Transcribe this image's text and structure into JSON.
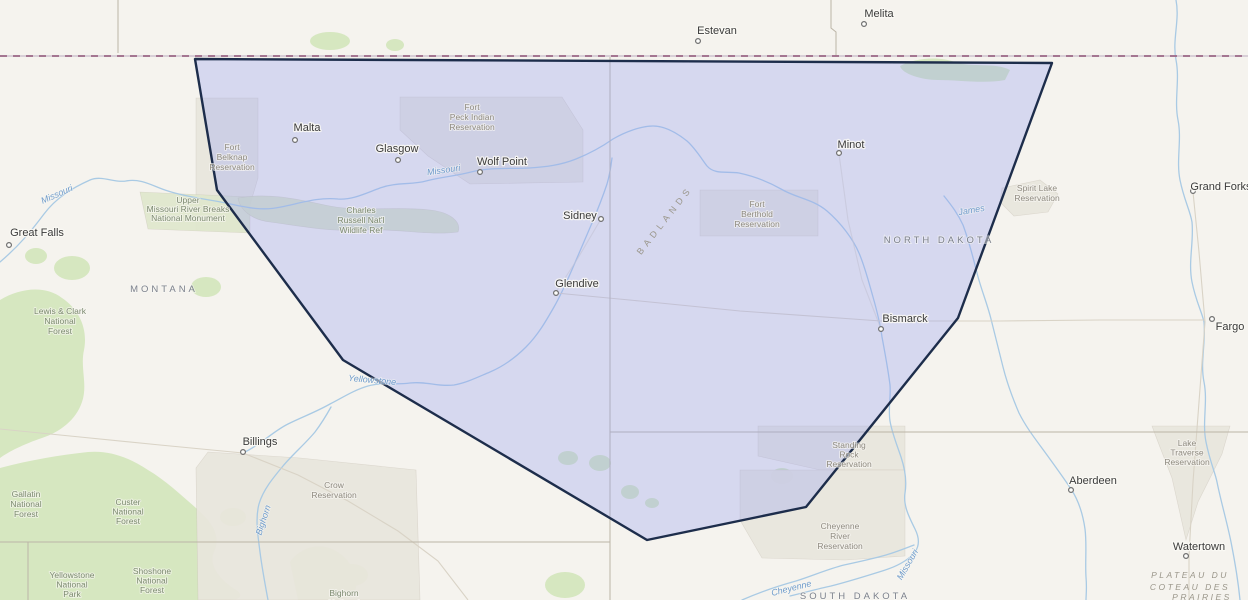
{
  "map": {
    "colors": {
      "background": "#f5f3ee",
      "forest": "#d6e7c0",
      "reservation": "#e9e6dd",
      "monument": "#e0e8cd",
      "refuge": "#dbe5c6",
      "river": "#a9cae4",
      "road": "#d9d3c6",
      "state_border": "#bcb5a7",
      "intl_border_base": "#cfc3cf",
      "intl_border_dash": "#9c6886",
      "overlay_fill": "#969ef4",
      "overlay_stroke": "#1d2d4b"
    },
    "overlay": {
      "fill_opacity": 0.32,
      "stroke_width": 2.4,
      "points": [
        [
          195,
          59
        ],
        [
          1052,
          63
        ],
        [
          958,
          318
        ],
        [
          806,
          507
        ],
        [
          647,
          540
        ],
        [
          343,
          360
        ],
        [
          217,
          190
        ]
      ]
    },
    "terrain": {
      "forests": [
        {
          "name": "lewis-clark-mass",
          "type": "path",
          "d": "M0,300 C20,288 45,285 62,298 C80,310 88,330 84,350 C80,368 88,385 82,402 C76,420 60,432 42,438 C24,444 8,452 0,458 Z"
        },
        {
          "name": "gallatin-custer-mass",
          "type": "path",
          "d": "M0,468 C30,460 60,455 88,452 C110,450 130,458 148,470 C165,480 180,494 196,508 C210,520 222,535 214,552 C208,565 220,580 236,590 C244,595 240,600 230,600 L0,600 Z"
        },
        {
          "name": "bears-paw",
          "type": "ellipse",
          "cx": 72,
          "cy": 268,
          "rx": 18,
          "ry": 12
        },
        {
          "name": "little-rockies",
          "type": "ellipse",
          "cx": 206,
          "cy": 287,
          "rx": 15,
          "ry": 10
        },
        {
          "name": "highwood",
          "type": "ellipse",
          "cx": 36,
          "cy": 256,
          "rx": 11,
          "ry": 8
        },
        {
          "name": "shoshone-mass",
          "type": "path",
          "d": "M96,564 C110,548 130,540 148,548 C166,556 178,572 172,588 C168,596 160,600 150,600 L104,600 Z"
        },
        {
          "name": "bighorn-mtns",
          "type": "path",
          "d": "M290,562 C300,548 318,542 334,550 C348,557 358,572 356,588 C354,596 346,600 336,600 L298,600 Z"
        },
        {
          "name": "crow-patch-1",
          "type": "ellipse",
          "cx": 233,
          "cy": 517,
          "rx": 13,
          "ry": 9
        },
        {
          "name": "crow-patch-2",
          "type": "ellipse",
          "cx": 352,
          "cy": 575,
          "rx": 16,
          "ry": 11
        },
        {
          "name": "turtle-mtns",
          "type": "path",
          "d": "M900,66 C915,58 938,56 955,62 C972,68 995,62 1010,70 L1005,80 C985,84 958,80 938,80 C922,80 902,74 900,66 Z"
        },
        {
          "name": "canada-blob-1",
          "type": "ellipse",
          "cx": 330,
          "cy": 41,
          "rx": 20,
          "ry": 9
        },
        {
          "name": "canada-blob-2",
          "type": "ellipse",
          "cx": 395,
          "cy": 45,
          "rx": 9,
          "ry": 6
        },
        {
          "name": "black-hills-edge",
          "type": "ellipse",
          "cx": 565,
          "cy": 585,
          "rx": 20,
          "ry": 13
        },
        {
          "name": "badlands-blob-1",
          "type": "ellipse",
          "cx": 568,
          "cy": 458,
          "rx": 10,
          "ry": 7
        },
        {
          "name": "badlands-blob-2",
          "type": "ellipse",
          "cx": 600,
          "cy": 463,
          "rx": 11,
          "ry": 8
        },
        {
          "name": "badlands-blob-3",
          "type": "ellipse",
          "cx": 630,
          "cy": 492,
          "rx": 9,
          "ry": 7
        },
        {
          "name": "badlands-blob-4",
          "type": "ellipse",
          "cx": 652,
          "cy": 503,
          "rx": 7,
          "ry": 5
        },
        {
          "name": "badlands-blob-5",
          "type": "ellipse",
          "cx": 782,
          "cy": 476,
          "rx": 11,
          "ry": 8
        }
      ],
      "areas": [
        {
          "name": "fort-peck-reservation",
          "kind": "reservation",
          "d": "M400,97 L562,97 L583,130 L583,182 L470,184 L428,156 L400,130 Z"
        },
        {
          "name": "fort-belknap-reservation",
          "kind": "reservation",
          "d": "M196,98 L258,98 L258,178 L242,232 L196,230 Z"
        },
        {
          "name": "fort-berthold-reservation",
          "kind": "reservation",
          "d": "M700,190 L818,190 L818,236 L700,236 Z"
        },
        {
          "name": "standing-rock-reservation",
          "kind": "reservation",
          "d": "M758,426 L905,426 L905,470 L820,470 L758,456 Z"
        },
        {
          "name": "cheyenne-river-reservation",
          "kind": "reservation",
          "d": "M740,470 L905,470 L905,556 L845,560 L762,558 L740,520 Z"
        },
        {
          "name": "crow-reservation",
          "kind": "reservation",
          "d": "M208,452 L300,458 L416,470 L420,600 L198,600 L196,468 Z"
        },
        {
          "name": "lake-traverse-reservation",
          "kind": "reservation",
          "d": "M1152,426 L1230,426 L1222,454 L1198,502 L1186,540 L1172,478 L1158,442 Z"
        },
        {
          "name": "spirit-lake-reservation",
          "kind": "reservation",
          "d": "M1002,188 L1040,180 L1058,194 L1048,212 L1014,216 L1000,202 Z"
        },
        {
          "name": "upper-missouri-monument",
          "kind": "monument",
          "d": "M140,192 L250,197 L250,233 L148,229 Z"
        },
        {
          "name": "charles-russell-refuge",
          "kind": "refuge",
          "d": "M238,198 C270,192 300,200 330,206 C360,212 395,206 430,210 C450,212 462,222 458,232 C430,236 395,228 360,230 C330,232 300,226 270,222 C252,220 240,210 238,198 Z"
        }
      ]
    },
    "rivers": [
      {
        "name": "missouri-river",
        "d": "M0,262 C20,245 32,230 44,214 C56,198 72,188 90,180 C102,175 114,183 126,181 C142,178 154,187 168,191 C186,197 206,199 226,203 C248,208 263,211 281,207 C301,203 318,197 338,199 C352,200 364,194 380,188 C396,182 412,185 426,181 C441,177 456,176 471,172 C491,167 511,169 529,168 C546,167 561,165 576,159 C591,153 603,146 613,139 C625,132 641,126 653,126 C665,126 677,133 687,141 C695,148 701,158 707,166 C715,175 727,171 739,173 C753,176 767,181 781,189 C796,198 813,199 827,211 C841,223 853,239 859,253 C865,267 869,283 873,297 C877,311 880,323 882,337 C885,353 888,369 890,385 C891,397 888,409 890,421 C892,433 897,445 901,457 C905,469 907,481 905,493 C903,505 909,517 915,529 C919,537 920,545 915,552 C907,562 893,568 879,572 C863,577 847,582 831,586 C817,589 803,593 790,596"
      },
      {
        "name": "yellowstone-river",
        "d": "M243,453 C262,444 272,432 288,424 C302,417 316,412 330,404 C342,398 354,390 368,386 C382,382 396,385 410,383 C426,381 438,387 454,385 C466,383 478,377 490,372 C504,366 516,357 526,347 C538,335 546,321 554,307 C562,293 568,279 574,265 C580,251 586,237 592,223 C598,209 603,196 607,184 C610,174 611,166 612,158"
      },
      {
        "name": "bighorn-river",
        "d": "M268,600 C265,584 262,568 260,552 C258,536 255,519 259,504 C263,490 273,478 283,466 C293,454 305,444 315,432 C321,424 326,416 331,407"
      },
      {
        "name": "red-river",
        "d": "M1176,0 C1180,20 1172,40 1176,60 C1180,80 1174,100 1178,120 C1182,140 1176,160 1180,180 C1184,200 1190,210 1192,222 C1194,242 1188,262 1192,282 C1196,302 1202,312 1204,322 C1206,342 1200,362 1204,382 C1208,402 1202,422 1206,442 C1210,462 1215,472 1217,482 C1221,502 1227,522 1231,542 C1235,562 1238,580 1240,600"
      },
      {
        "name": "james-river",
        "d": "M944,196 C952,206 958,214 963,225 C969,241 973,257 977,273 C981,289 987,303 991,319 C995,335 999,351 1003,367 C1007,383 1013,399 1019,413 C1027,429 1037,441 1047,455 C1055,466 1063,477 1071,489 C1079,501 1083,515 1085,529 C1087,545 1085,561 1086,577 C1087,589 1086,595 1086,600"
      },
      {
        "name": "cheyenne-river",
        "d": "M742,600 C760,592 778,586 796,581 C812,576 828,569 844,565 C858,562 872,559 886,555 C896,552 906,548 914,545"
      }
    ],
    "roads": [
      {
        "name": "interstate-94",
        "opacity": 1,
        "d": "M556,293 L640,301 L740,311 L881,321 L1000,321 L1100,320 L1205,320"
      },
      {
        "name": "interstate-29",
        "opacity": 1,
        "d": "M1193,192 L1199,252 L1205,322 L1199,402 L1193,482 L1189,556 L1189,600"
      },
      {
        "name": "interstate-90",
        "opacity": 1,
        "d": "M0,429 L80,437 L160,445 L243,453 L298,475 L348,501 L398,531 L438,561 L468,600"
      },
      {
        "name": "us-83",
        "opacity": 0.6,
        "d": "M881,329 L862,280 L848,220 L839,154"
      },
      {
        "name": "glendive-sidney-road",
        "opacity": 0.6,
        "d": "M556,292 L578,258 L601,219"
      }
    ],
    "borders": {
      "international": {
        "name": "us-canada-border",
        "d": "M0,56 L1248,56"
      },
      "state": [
        {
          "name": "montana-dakota-border",
          "d": "M610,57 L610,542"
        },
        {
          "name": "nd-sd-border",
          "d": "M610,432 L1248,432"
        },
        {
          "name": "montana-wyoming-border",
          "d": "M0,542 L610,542"
        },
        {
          "name": "wyoming-sd-border",
          "d": "M610,542 L610,600"
        },
        {
          "name": "alberta-sask-border",
          "d": "M118,0 L118,53"
        },
        {
          "name": "sask-manitoba-border",
          "d": "M831,0 L831,28 L836,32 L836,56"
        },
        {
          "name": "yellowstone-park-boundary",
          "d": "M28,542 L28,600"
        }
      ]
    },
    "cities": [
      {
        "name": "estevan",
        "label": "Estevan",
        "tx": 717,
        "ty": 34,
        "mx": 698,
        "my": 41
      },
      {
        "name": "melita",
        "label": "Melita",
        "tx": 879,
        "ty": 17,
        "mx": 864,
        "my": 24
      },
      {
        "name": "malta",
        "label": "Malta",
        "tx": 307,
        "ty": 131,
        "mx": 295,
        "my": 140
      },
      {
        "name": "glasgow",
        "label": "Glasgow",
        "tx": 397,
        "ty": 152,
        "mx": 398,
        "my": 160
      },
      {
        "name": "wolf-point",
        "label": "Wolf Point",
        "tx": 502,
        "ty": 165,
        "mx": 480,
        "my": 172
      },
      {
        "name": "sidney",
        "label": "Sidney",
        "tx": 580,
        "ty": 219,
        "mx": 601,
        "my": 219
      },
      {
        "name": "glendive",
        "label": "Glendive",
        "tx": 577,
        "ty": 287,
        "mx": 556,
        "my": 293
      },
      {
        "name": "minot",
        "label": "Minot",
        "tx": 851,
        "ty": 148,
        "mx": 839,
        "my": 153
      },
      {
        "name": "bismarck",
        "label": "Bismarck",
        "tx": 905,
        "ty": 322,
        "mx": 881,
        "my": 329
      },
      {
        "name": "fargo",
        "label": "Fargo",
        "tx": 1230,
        "ty": 330,
        "mx": 1212,
        "my": 319
      },
      {
        "name": "grand-forks",
        "label": "Grand Forks",
        "tx": 1221,
        "ty": 190,
        "mx": 1193,
        "my": 191
      },
      {
        "name": "aberdeen",
        "label": "Aberdeen",
        "tx": 1093,
        "ty": 484,
        "mx": 1071,
        "my": 490
      },
      {
        "name": "watertown",
        "label": "Watertown",
        "tx": 1199,
        "ty": 550,
        "mx": 1186,
        "my": 556
      },
      {
        "name": "billings",
        "label": "Billings",
        "tx": 260,
        "ty": 445,
        "mx": 243,
        "my": 452
      },
      {
        "name": "great-falls",
        "label": "Great Falls",
        "tx": 37,
        "ty": 236,
        "mx": 9,
        "my": 245
      }
    ],
    "labels": {
      "states": [
        {
          "name": "montana",
          "text": "MONTANA",
          "x": 164,
          "y": 292
        },
        {
          "name": "north-dakota",
          "text": "NORTH DAKOTA",
          "x": 939,
          "y": 243
        },
        {
          "name": "south-dakota",
          "text": "SOUTH DAKOTA",
          "x": 855,
          "y": 599
        }
      ],
      "areas": [
        {
          "name": "fort-belknap-label",
          "cls": "res",
          "x": 232,
          "y": 150,
          "lh": 10,
          "lines": [
            "Fort",
            "Belknap",
            "Reservation"
          ]
        },
        {
          "name": "fort-peck-label",
          "cls": "res",
          "x": 472,
          "y": 110,
          "lh": 10,
          "lines": [
            "Fort",
            "Peck Indian",
            "Reservation"
          ]
        },
        {
          "name": "charles-russell-label",
          "cls": "for",
          "x": 361,
          "y": 213,
          "lh": 10,
          "lines": [
            "Charles",
            "Russell Nat'l",
            "Wildlife Ref"
          ]
        },
        {
          "name": "upper-missouri-label",
          "cls": "for",
          "x": 188,
          "y": 203,
          "lh": 9,
          "lines": [
            "Upper",
            "Missouri River Breaks",
            "National Monument"
          ]
        },
        {
          "name": "fort-berthold-label",
          "cls": "res",
          "x": 757,
          "y": 207,
          "lh": 10,
          "lines": [
            "Fort",
            "Berthold",
            "Reservation"
          ]
        },
        {
          "name": "standing-rock-label",
          "cls": "res",
          "x": 849,
          "y": 448,
          "lh": 9.5,
          "lines": [
            "Standing",
            "Rock",
            "Reservation"
          ]
        },
        {
          "name": "cheyenne-river-label",
          "cls": "res",
          "x": 840,
          "y": 529,
          "lh": 10,
          "lines": [
            "Cheyenne",
            "River",
            "Reservation"
          ]
        },
        {
          "name": "lake-traverse-label",
          "cls": "res",
          "x": 1187,
          "y": 446,
          "lh": 9.5,
          "lines": [
            "Lake",
            "Traverse",
            "Reservation"
          ]
        },
        {
          "name": "spirit-lake-label",
          "cls": "res",
          "x": 1037,
          "y": 191,
          "lh": 10,
          "lines": [
            "Spirit Lake",
            "Reservation"
          ]
        },
        {
          "name": "crow-label",
          "cls": "res",
          "x": 334,
          "y": 488,
          "lh": 10,
          "lines": [
            "Crow",
            "Reservation"
          ]
        },
        {
          "name": "lewis-clark-label",
          "cls": "for",
          "x": 60,
          "y": 314,
          "lh": 10,
          "lines": [
            "Lewis & Clark",
            "National",
            "Forest"
          ]
        },
        {
          "name": "gallatin-label",
          "cls": "for",
          "x": 26,
          "y": 497,
          "lh": 10,
          "lines": [
            "Gallatin",
            "National",
            "Forest"
          ]
        },
        {
          "name": "custer-label",
          "cls": "for",
          "x": 128,
          "y": 505,
          "lh": 9.5,
          "lines": [
            "Custer",
            "National",
            "Forest"
          ]
        },
        {
          "name": "yellowstone-park-label",
          "cls": "for",
          "x": 72,
          "y": 578,
          "lh": 9.5,
          "lines": [
            "Yellowstone",
            "National",
            "Park"
          ]
        },
        {
          "name": "shoshone-label",
          "cls": "for",
          "x": 152,
          "y": 574,
          "lh": 9.5,
          "lines": [
            "Shoshone",
            "National",
            "Forest"
          ]
        },
        {
          "name": "bighorn-forest-label",
          "cls": "for",
          "x": 344,
          "y": 596,
          "lh": 10,
          "lines": [
            "Bighorn",
            "National"
          ]
        }
      ],
      "rivers": [
        {
          "name": "missouri-label-west",
          "text": "Missouri",
          "x": 58,
          "y": 197,
          "rot": -24
        },
        {
          "name": "missouri-label-mid",
          "text": "Missouri",
          "x": 444,
          "y": 173,
          "rot": -8
        },
        {
          "name": "yellowstone-label",
          "text": "Yellowstone",
          "x": 372,
          "y": 383,
          "rot": 5
        },
        {
          "name": "james-label",
          "text": "James",
          "x": 972,
          "y": 213,
          "rot": -10
        },
        {
          "name": "bighorn-label",
          "text": "Bighorn",
          "x": 266,
          "y": 521,
          "rot": -72
        },
        {
          "name": "missouri-label-south",
          "text": "Missouri",
          "x": 910,
          "y": 566,
          "rot": -60
        },
        {
          "name": "cheyenne-label",
          "text": "Cheyenne",
          "x": 792,
          "y": 591,
          "rot": -14
        }
      ],
      "physio": [
        {
          "name": "badlands-label",
          "cls": "physio",
          "text": "BADLANDS",
          "x": 667,
          "y": 222,
          "rot": -52
        },
        {
          "name": "plateau-line-1",
          "cls": "physio-it",
          "text": "PLATEAU DU",
          "x": 1190,
          "y": 578,
          "rot": 0
        },
        {
          "name": "plateau-line-2",
          "cls": "physio-it",
          "text": "COTEAU DES",
          "x": 1190,
          "y": 590,
          "rot": 0
        },
        {
          "name": "plateau-line-3",
          "cls": "physio-it",
          "text": "PRAIRIES",
          "x": 1202,
          "y": 600,
          "rot": 0
        }
      ]
    }
  }
}
